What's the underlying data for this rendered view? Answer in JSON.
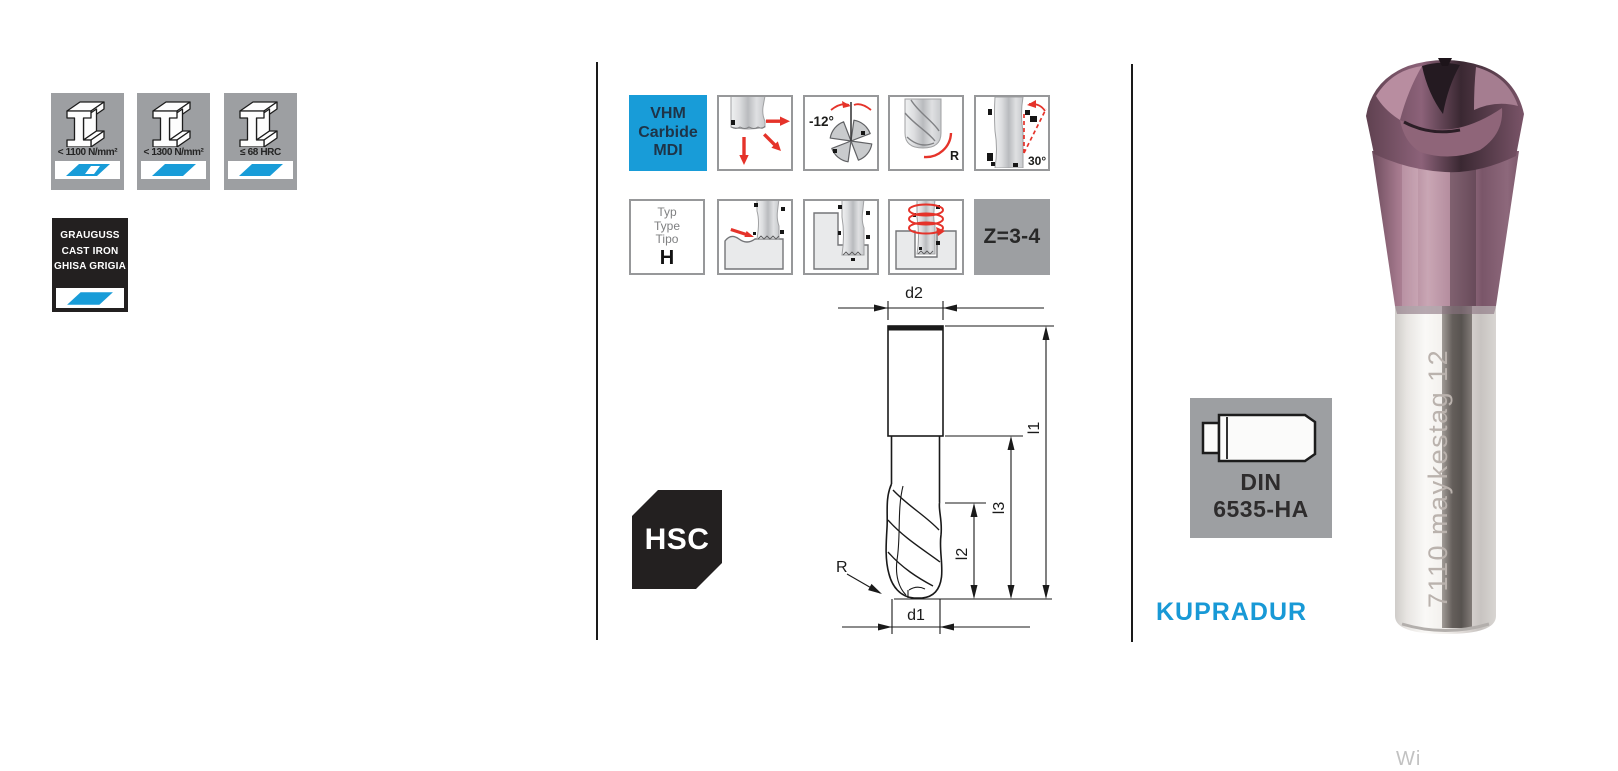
{
  "colors": {
    "accent_blue": "#189cd8",
    "warning_red": "#e5332a",
    "gray_card": "#9d9fa2",
    "black_card": "#232020"
  },
  "left": {
    "materials": [
      {
        "label": "< 1100 N/mm²",
        "fill": "partial"
      },
      {
        "label": "< 1300 N/mm²",
        "fill": "full"
      },
      {
        "label": "≤ 68 HRC",
        "fill": "full"
      }
    ],
    "cast_iron": {
      "line1": "GRAUGUSS",
      "line2": "CAST IRON",
      "line3": "GHISA GRIGIA"
    }
  },
  "middle": {
    "vhm": {
      "line1": "VHM",
      "line2": "Carbide",
      "line3": "MDI"
    },
    "helix_angle": "-12°",
    "radius_label": "R",
    "angle_label": "30°",
    "typ": {
      "line1": "Typ",
      "line2": "Type",
      "line3": "Tipo",
      "value": "H"
    },
    "flutes": "Z=3-4",
    "hsc": "HSC",
    "drawing": {
      "d2": "d2",
      "d1": "d1",
      "l1": "l1",
      "l2": "l2",
      "l3": "l3",
      "r": "R"
    }
  },
  "right": {
    "din_line1": "DIN",
    "din_line2": "6535-HA",
    "brand": "KUPRADUR",
    "tool_marking": "7110 maykestag 12",
    "partial_text": "Wi"
  },
  "icons": {
    "material": "i-beam-icon",
    "plunge": "multi-direction-arrows-icon",
    "helix": "negative-helix-angle-icon",
    "corner_radius": "corner-radius-icon",
    "angle": "angle-30-icon",
    "copy_milling": "copy-milling-icon",
    "shoulder_milling": "shoulder-milling-icon",
    "helical_interpolation": "helical-interpolation-icon",
    "shank": "din-shank-icon"
  }
}
